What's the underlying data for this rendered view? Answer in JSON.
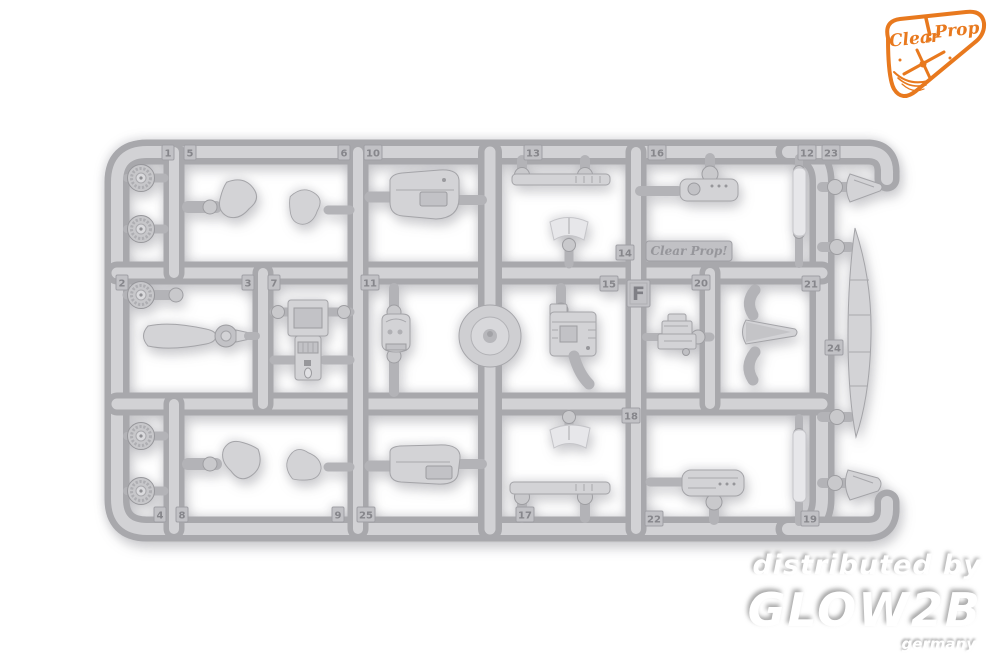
{
  "photo": {
    "background_color": "#ffffff"
  },
  "logo": {
    "brand_first": "Clear",
    "brand_second": "Prop!",
    "accent_color": "#E8791E"
  },
  "sprue": {
    "plastic_color": "#c3c3c7",
    "sprue_letter": "F",
    "embossed_brand": "Clear Prop!",
    "part_tags": [
      {
        "label": "1",
        "x": 64,
        "y": 15
      },
      {
        "label": "5",
        "x": 86,
        "y": 15
      },
      {
        "label": "6",
        "x": 240,
        "y": 15
      },
      {
        "label": "10",
        "x": 266,
        "y": 15
      },
      {
        "label": "13",
        "x": 426,
        "y": 15
      },
      {
        "label": "16",
        "x": 550,
        "y": 15
      },
      {
        "label": "12",
        "x": 700,
        "y": 15
      },
      {
        "label": "23",
        "x": 724,
        "y": 15
      },
      {
        "label": "2",
        "x": 18,
        "y": 145
      },
      {
        "label": "3",
        "x": 144,
        "y": 145
      },
      {
        "label": "7",
        "x": 170,
        "y": 145
      },
      {
        "label": "11",
        "x": 263,
        "y": 145
      },
      {
        "label": "15",
        "x": 502,
        "y": 146
      },
      {
        "label": "14",
        "x": 518,
        "y": 115
      },
      {
        "label": "20",
        "x": 594,
        "y": 145
      },
      {
        "label": "21",
        "x": 704,
        "y": 146
      },
      {
        "label": "24",
        "x": 727,
        "y": 210
      },
      {
        "label": "18",
        "x": 524,
        "y": 278
      },
      {
        "label": "4",
        "x": 56,
        "y": 377
      },
      {
        "label": "8",
        "x": 78,
        "y": 377
      },
      {
        "label": "9",
        "x": 234,
        "y": 377
      },
      {
        "label": "25",
        "x": 259,
        "y": 377
      },
      {
        "label": "17",
        "x": 418,
        "y": 377
      },
      {
        "label": "22",
        "x": 547,
        "y": 381
      },
      {
        "label": "19",
        "x": 703,
        "y": 381
      }
    ]
  },
  "watermark": {
    "line1": "distributed by",
    "line2": "GLOW2B",
    "line3": "germany",
    "text_color": "#ffffff"
  }
}
